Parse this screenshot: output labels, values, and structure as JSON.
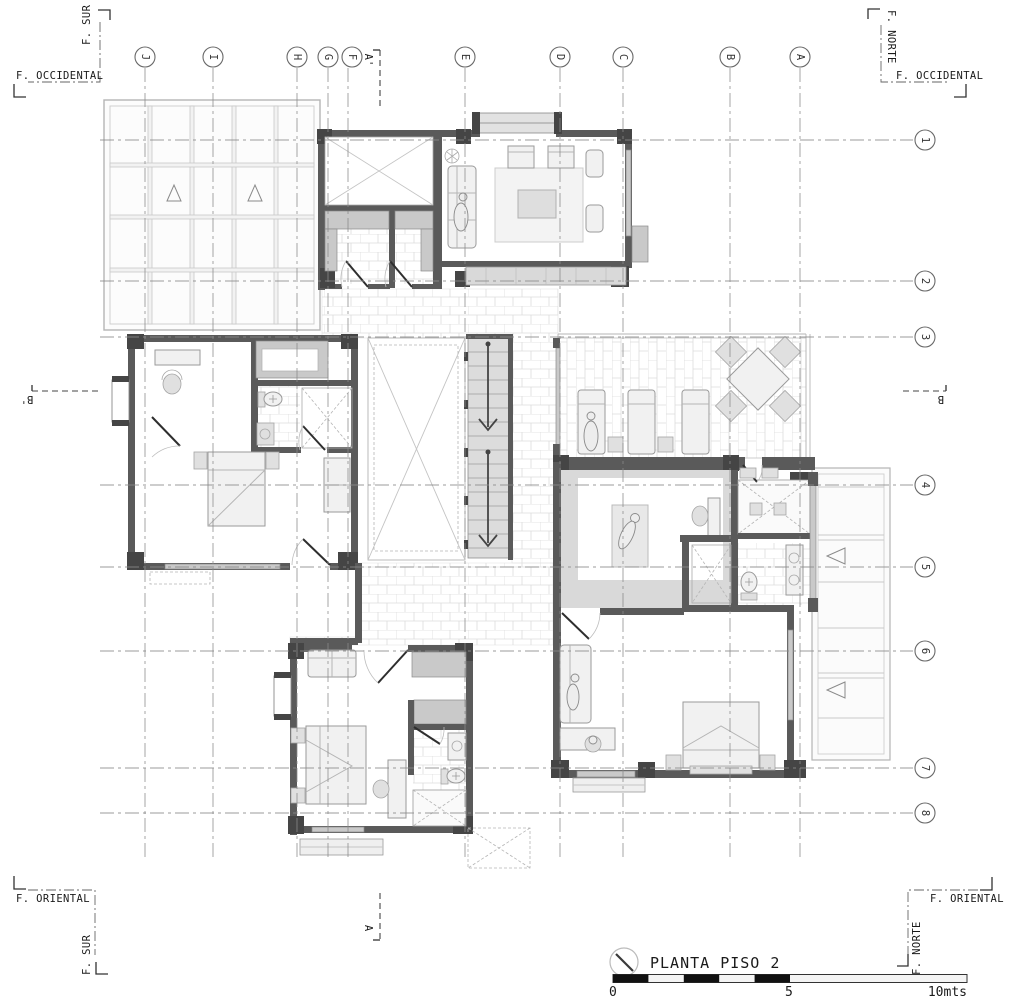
{
  "drawing": {
    "title": "PLANTA PISO 2",
    "scale_bar": {
      "zero": "0",
      "five": "5",
      "ten": "10mts"
    }
  },
  "facades": {
    "top_left_v": "F. SUR",
    "top_left_h": "F. OCCIDENTAL",
    "top_right_v": "F. NORTE",
    "top_right_h": "F. OCCIDENTAL",
    "bottom_left_h": "F. ORIENTAL",
    "bottom_left_v": "F. SUR",
    "bottom_right_h": "F. ORIENTAL",
    "bottom_right_v": "F. NORTE"
  },
  "grid": {
    "columns": [
      "J",
      "I",
      "H",
      "G",
      "F",
      "E",
      "D",
      "C",
      "B",
      "A"
    ],
    "rows": [
      "1",
      "2",
      "3",
      "4",
      "5",
      "6",
      "7",
      "8"
    ]
  },
  "sections": {
    "top": "A'",
    "bottom": "A",
    "left": "B'",
    "right": "B"
  },
  "colors": {
    "wall": "#5a5a5a",
    "column": "#454545",
    "grid_line": "#8a8a8a",
    "tile_line": "#dcdcdc",
    "text": "#1a1a1a"
  }
}
